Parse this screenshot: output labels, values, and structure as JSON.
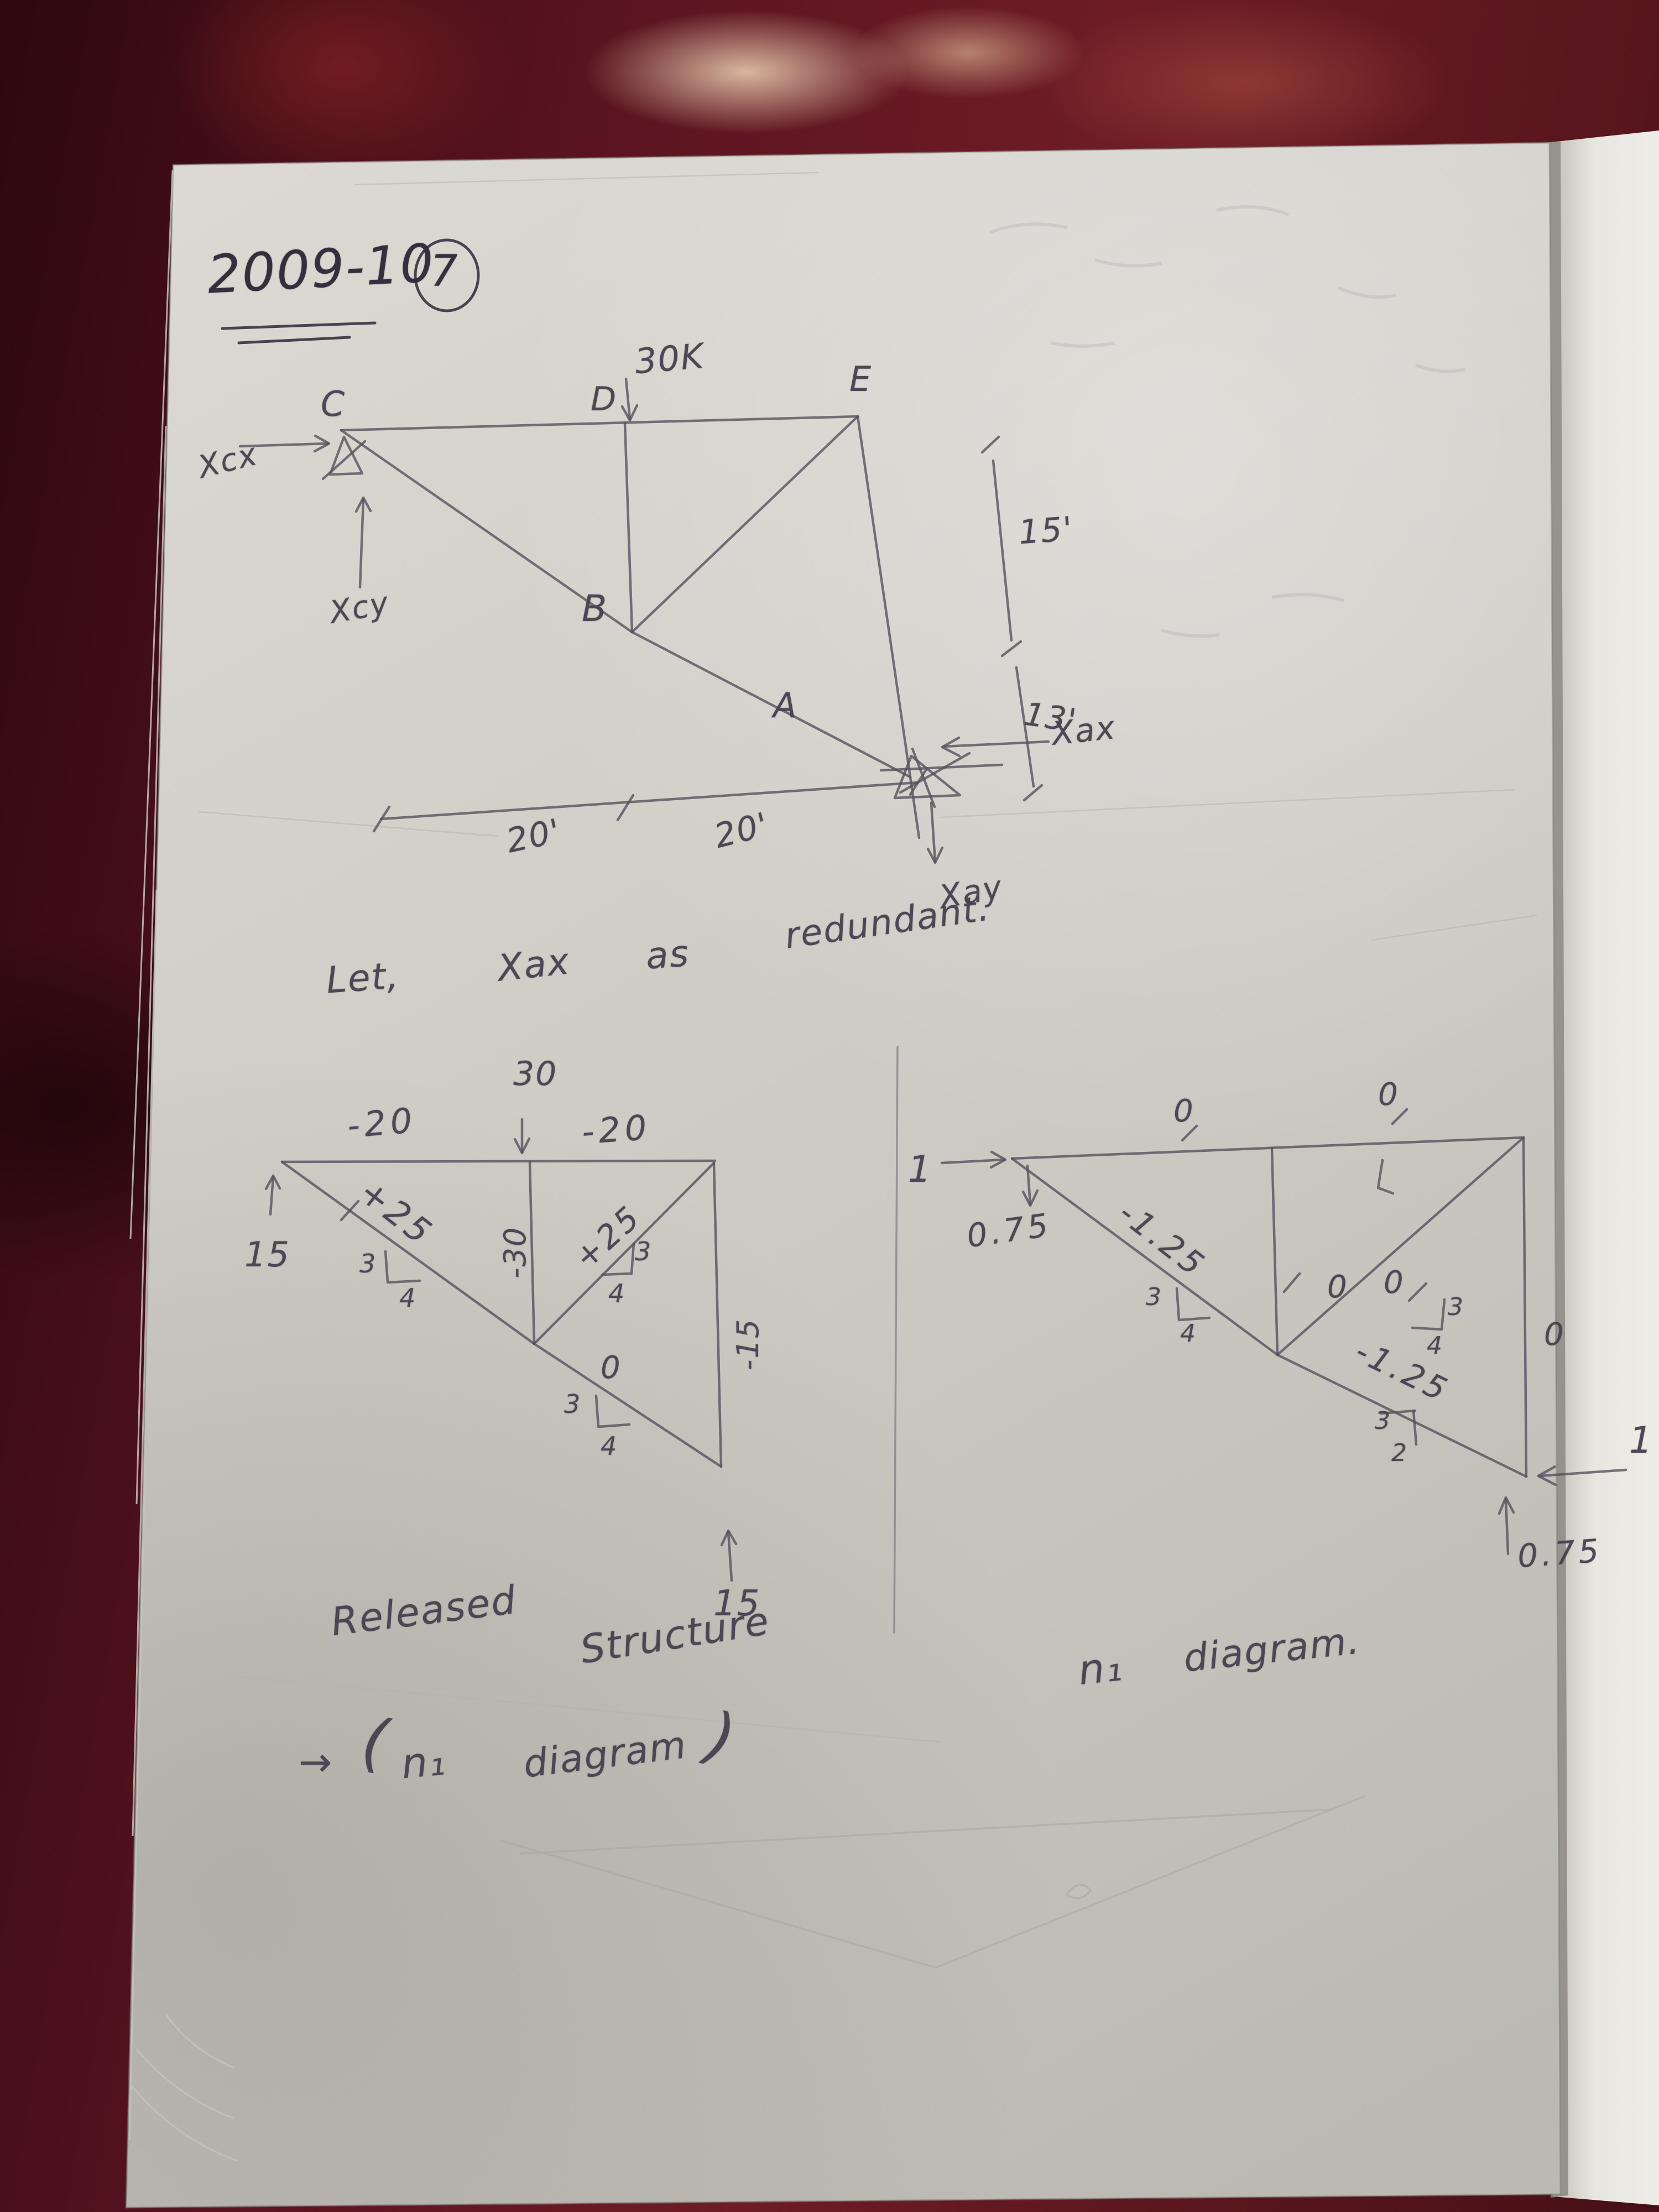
{
  "header": {
    "session": "2009-10",
    "page": "7"
  },
  "note": [
    "Let,",
    "Xax",
    "as",
    "redundant."
  ],
  "truss": {
    "nodes": {
      "c": "C",
      "d": "D",
      "e": "E",
      "b": "B",
      "a": "A"
    },
    "load": "30K",
    "reactions": {
      "cx": "Xcx",
      "cy": "Xcy",
      "ax": "Xax",
      "ay": "Xay"
    },
    "dims": {
      "height_upper": "15'",
      "height_lower": "13'",
      "span_left": "20'",
      "span_right": "20'"
    }
  },
  "released": {
    "load": "30",
    "members": {
      "top_left": "-20",
      "top_right": "-20",
      "left_diagonal": "+25",
      "center_vertical": "-30",
      "right_diagonal": "+25",
      "right_vertical": "-15",
      "lower_diagonal": "0"
    },
    "reactions": {
      "left": "15",
      "bottom": "15"
    },
    "slope": {
      "rise": "3",
      "run": "4"
    },
    "caption": [
      "Released",
      "Structure",
      "→",
      "(",
      "n₁",
      "diagram",
      ")"
    ]
  },
  "n1": {
    "unit_loads": {
      "left": "1",
      "right": "1"
    },
    "reactions": {
      "left": "0.75",
      "right": "0.75"
    },
    "members": {
      "top_left": "0",
      "top_right": "0",
      "left_diagonal": "-1.25",
      "center_vertical": "0",
      "right_diagonal": "0",
      "right_vertical": "0",
      "lower_diagonal": "-1.25"
    },
    "slope": {
      "rise": "3",
      "run": "4"
    },
    "lower_slope": {
      "rise": "3",
      "run": "2"
    },
    "caption": [
      "n₁",
      "diagram."
    ]
  }
}
